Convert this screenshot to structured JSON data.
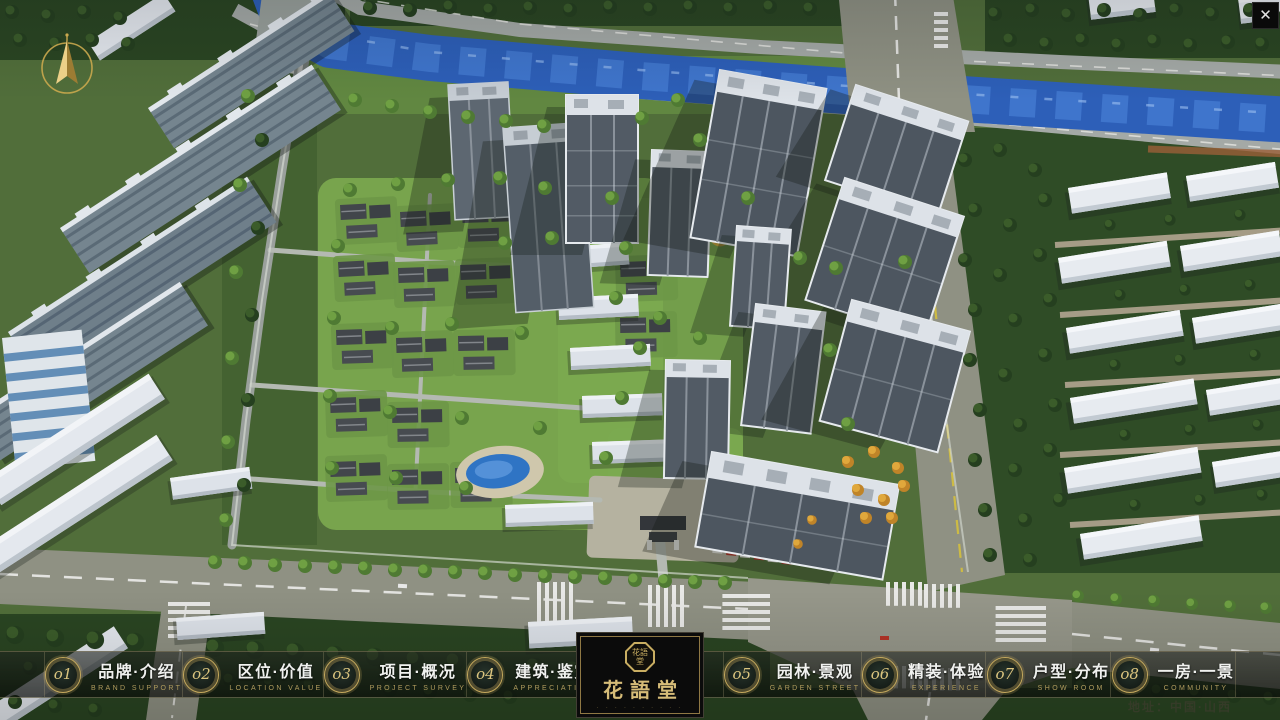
{
  "window": {
    "close_icon": "✕"
  },
  "map": {
    "address_label": "地址：中国·山西"
  },
  "logo": {
    "seal": "花語堂",
    "title": "花語堂",
    "subtext": "· · · · · · · · · ·"
  },
  "nav": {
    "items": [
      {
        "num": "o1",
        "title": "品牌·介绍",
        "subtitle": "BRAND SUPPORT"
      },
      {
        "num": "o2",
        "title": "区位·价值",
        "subtitle": "LOCATION VALUE"
      },
      {
        "num": "o3",
        "title": "项目·概况",
        "subtitle": "PROJECT SURVEY"
      },
      {
        "num": "o4",
        "title": "建筑·鉴赏",
        "subtitle": "APPRECIATION"
      },
      {
        "num": "o5",
        "title": "园林·景观",
        "subtitle": "GARDEN STREET"
      },
      {
        "num": "o6",
        "title": "精装·体验",
        "subtitle": "EXPERIENCE"
      },
      {
        "num": "o7",
        "title": "户型·分布",
        "subtitle": "SHOW ROOM"
      },
      {
        "num": "o8",
        "title": "一房·一景",
        "subtitle": "COMMUNITY"
      }
    ]
  },
  "palette": {
    "gold": "#c9ae62",
    "river": "#2d5fb8",
    "navbar": "#141a14",
    "road": "#8f9183",
    "foliage": "#2a4522"
  }
}
